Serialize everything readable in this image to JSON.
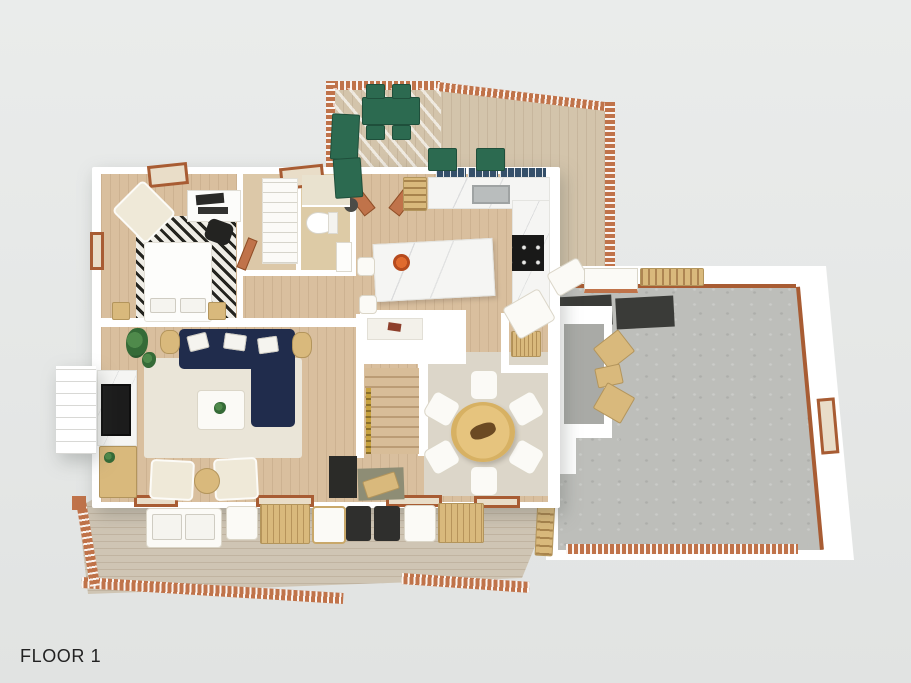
{
  "floor_label": "FLOOR 1",
  "colors": {
    "bg": "#eaeceb",
    "bg2": "#e1e3e2",
    "wall": "#ffffff",
    "wood_floor": "#d9bf9e",
    "closet_floor": "#dcc8a8",
    "deck_floor": "#cfc5b4",
    "deck_top_floor": "#d3c4ab",
    "railing": "#c0734a",
    "railing_dark": "#a85c33",
    "garage_floor": "#bdbeba",
    "garage_floor_dark": "#a9aaa6",
    "rug_living": "#eae5d8",
    "rug_dining": "#dcd6c9",
    "rug_chevron_dark": "#24241f",
    "rug_chevron_light": "#efede6",
    "sofa_navy": "#202c4c",
    "green_furniture": "#2c6a50",
    "marble": "#f5f5f3",
    "oak_table": "#e6c47e",
    "wood_furniture": "#d9b97c",
    "stove_black": "#191918",
    "mat_dark": "#3a3b38",
    "olive_mat": "#8e8d75",
    "gold_rail": "#c7a23f",
    "tile_bath": "#ddcba6",
    "cream_chair": "#efe9d8",
    "text": "#222222"
  }
}
